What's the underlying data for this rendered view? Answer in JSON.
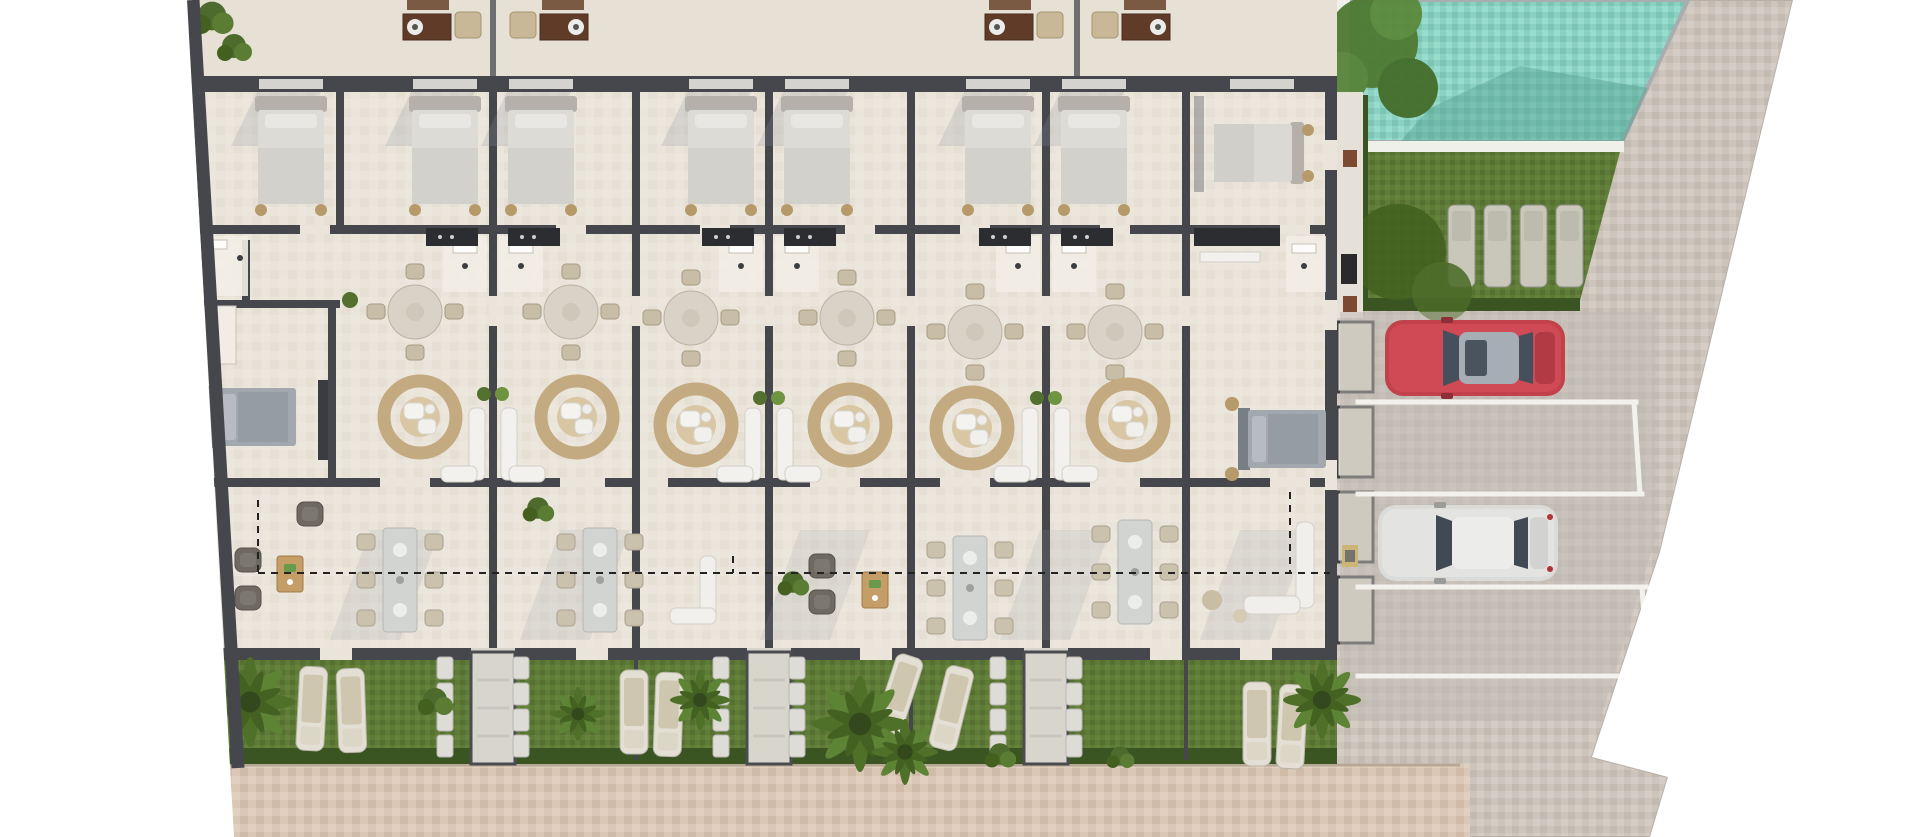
{
  "scene": {
    "type": "architectural-site-plan-render",
    "caption": "Top-down 3D rendering of a row of mirrored townhouses with furnished interiors (beds, round dining tables, rattan rugs with armchairs, kitchens, bathrooms), rear roof terraces with outdoor lounge sets, private rear gardens with sun loungers, stepping stones and palm trees, a communal swimming pool with lawn and four sun loungers, and a cobbled parking court with a red car and a white car. A dashed property line crosses the terraces.",
    "units_visible": 7,
    "pool": {
      "loungers": 4
    },
    "gardens": {
      "paths": 3,
      "palm_trees": 6
    },
    "parking": {
      "bays": 4,
      "cars": [
        {
          "color": "red"
        },
        {
          "color": "silver-white"
        }
      ]
    }
  },
  "colors": {
    "wall": "#46474c",
    "floor": "#eae4da",
    "roof": "#e6e0d5",
    "pool": "#8bd1c1",
    "lawn": "#5e7b37",
    "hedge": "#3a5422",
    "plaza": "#cdc4bc",
    "sidewalk": "#dac7b6",
    "carRed": "#c2424c",
    "carWhite": "#dbdbd9",
    "rug": "#c3aa80",
    "shadow": "#8c93a0"
  }
}
